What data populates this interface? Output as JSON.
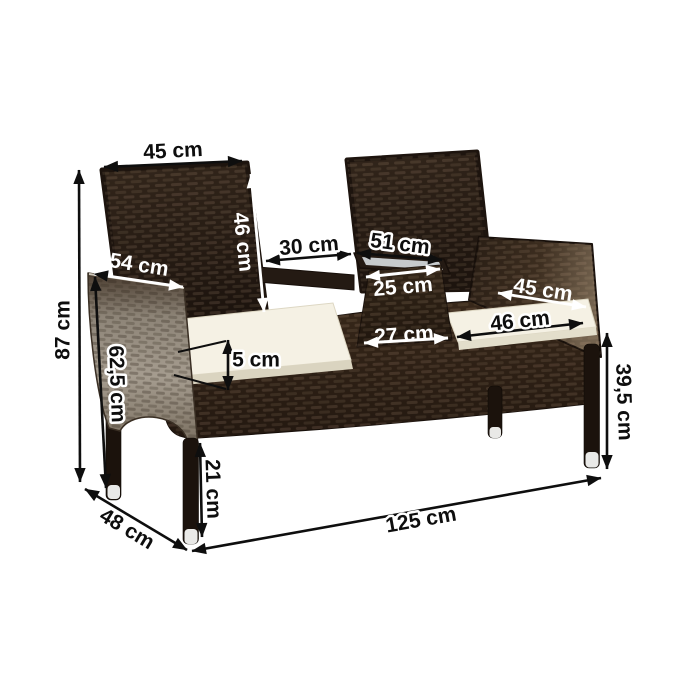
{
  "colors": {
    "background": "#ffffff",
    "annotation_dark": "#0e0e0e",
    "annotation_light": "#ffffff",
    "rattan_dark": "#241a13",
    "rattan_mid": "#3a2c20",
    "armrest_light": "#9a9184",
    "cushion": "#f5f1e4",
    "cushion_shade": "#ddd7c3",
    "glass": "#c6cacc",
    "leg": "#1b120c",
    "leg_cap": "#e9e9e7"
  },
  "dimensions": {
    "left_backrest_width": "45 cm",
    "left_backrest_height": "46 cm",
    "seat_gap_width": "30 cm",
    "table_top_width": "51 cm",
    "armrest_depth": "54 cm",
    "table_middle_width": "25 cm",
    "right_seat_back_width": "45 cm",
    "table_base_width": "27 cm",
    "right_seat_front_width": "46 cm",
    "total_height": "87 cm",
    "armrest_height": "62,5 cm",
    "cushion_thickness": "5 cm",
    "front_leg_height": "21 cm",
    "bench_depth": "48 cm",
    "total_width": "125 cm",
    "seat_frame_height": "39,5 cm"
  }
}
